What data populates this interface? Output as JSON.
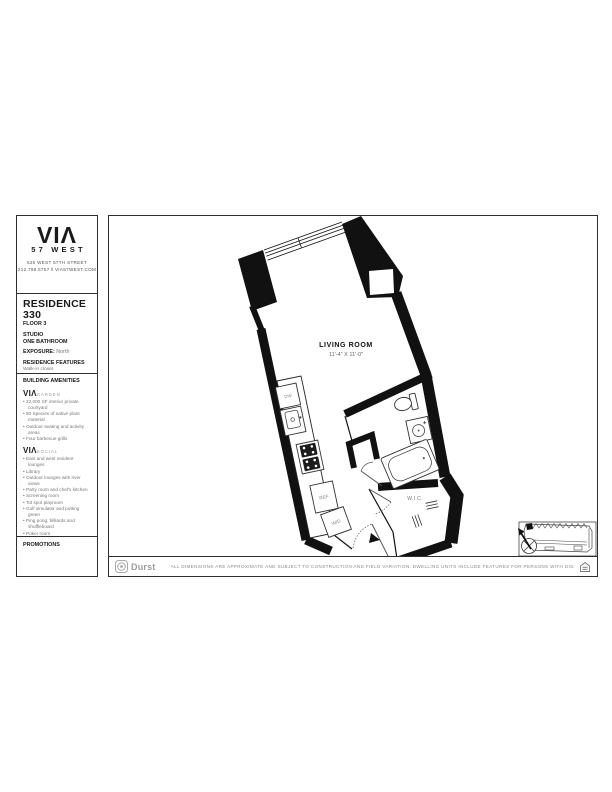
{
  "brand": {
    "logo": "VIΛ",
    "sub": "57 WEST",
    "address_line1": "625 WEST 57TH STREET",
    "address_line2": "212.789.5757 ‖ VIA57WEST.COM"
  },
  "residence": {
    "title": "RESIDENCE 330",
    "floor": "FLOOR 3",
    "type_line1": "STUDIO",
    "type_line2": "ONE BATHROOM",
    "exposure_label": "EXPOSURE:",
    "exposure_value": "North",
    "features_header": "RESIDENCE FEATURES",
    "features": [
      "Walk-in closet",
      "Linen closet",
      "Washer/Dryer"
    ],
    "rent_header": "MONTHLY RENT"
  },
  "amenities": {
    "header": "BUILDING AMENITIES",
    "brand_mark": "VIΛ",
    "groups": [
      {
        "name": "GARDEN",
        "items": [
          "22,000 SF interior private courtyard",
          "50 Species of native plant material",
          "Outdoor seating and activity areas",
          "Four barbecue grills"
        ]
      },
      {
        "name": "SOCIAL",
        "items": [
          "East and west resident lounges",
          "Library",
          "Outdoor lounges with river views",
          "Party room and chef's kitchen",
          "Screening room",
          "Tot spot playroom",
          "Golf simulator and putting green",
          "Ping pong, billiards and shuffleboard",
          "Poker room"
        ]
      },
      {
        "name": "FIT",
        "items": [
          "High-performance gym equipment",
          "Wellness lounge",
          "Swimming pool and sun decks",
          "Exercise and spin studios",
          "Indoor half-court basketball"
        ]
      }
    ]
  },
  "promotions": {
    "header": "PROMOTIONS"
  },
  "plan": {
    "room_label": "LIVING ROOM",
    "room_dims": "11'-4\" X 11'-0\"",
    "labels": {
      "dw": "DW",
      "ref": "REF",
      "wd": "W/D",
      "wic": "W.I.C."
    }
  },
  "footer": {
    "durst": "Durst",
    "disclaimer": "ALL DIMENSIONS ARE APPROXIMATE AND SUBJECT TO CONSTRUCTION AND FIELD VARIATION.  DWELLING UNITS INCLUDE FEATURES FOR PERSONS WITH DISABILITIES REQUIRED BY THE FHA."
  },
  "colors": {
    "wall": "#111111",
    "text_dark": "#1a1a1a",
    "text_gray": "#777777"
  }
}
